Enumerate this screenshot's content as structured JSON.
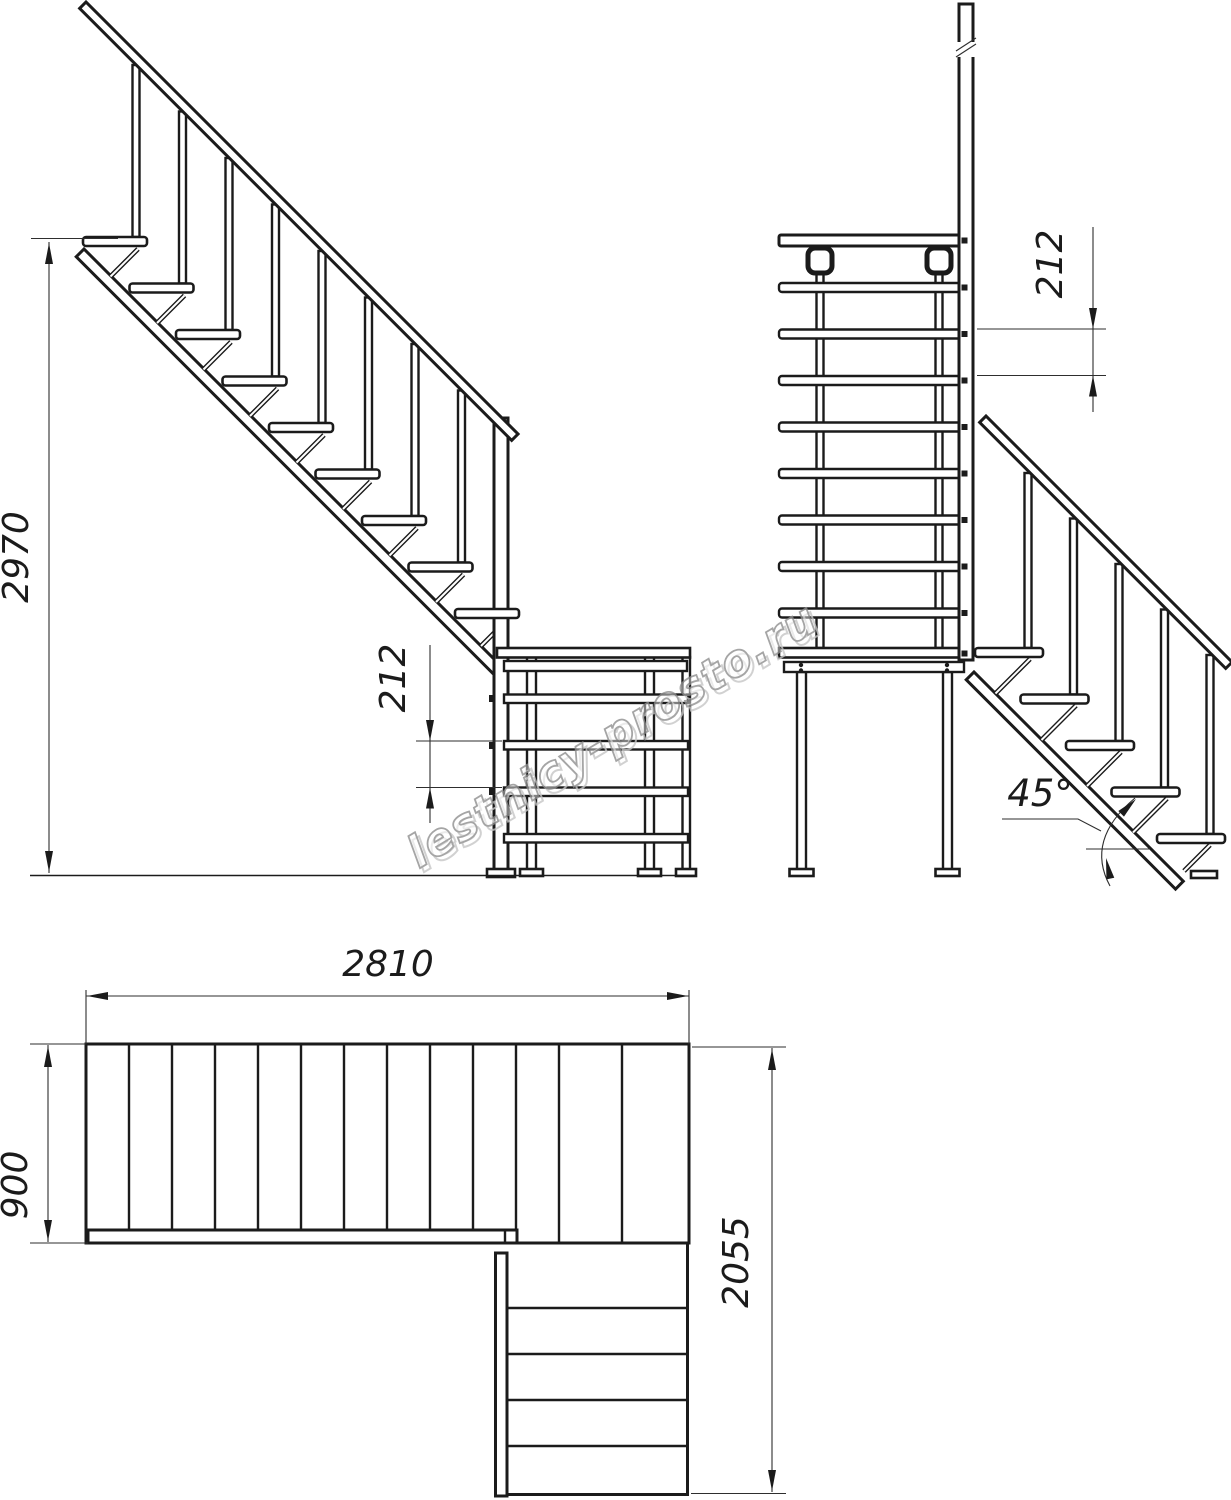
{
  "drawing": {
    "type": "staircase-technical-drawing",
    "views": [
      "side-elevation",
      "front-elevation",
      "plan"
    ]
  },
  "dimensions": {
    "side_total_height": "2970",
    "side_step_rise": "212",
    "front_step_rise": "212",
    "front_angle": "45°",
    "plan_upper_run_length": "2810",
    "plan_flight_width": "900",
    "plan_lower_run_length": "2055"
  },
  "watermark": {
    "text": "lestnicy-prosto.ru"
  },
  "colors": {
    "line": "#1b1b1b",
    "dimension": "#2e2e2e",
    "watermark": "#8f8f8f",
    "background": "#ffffff"
  }
}
